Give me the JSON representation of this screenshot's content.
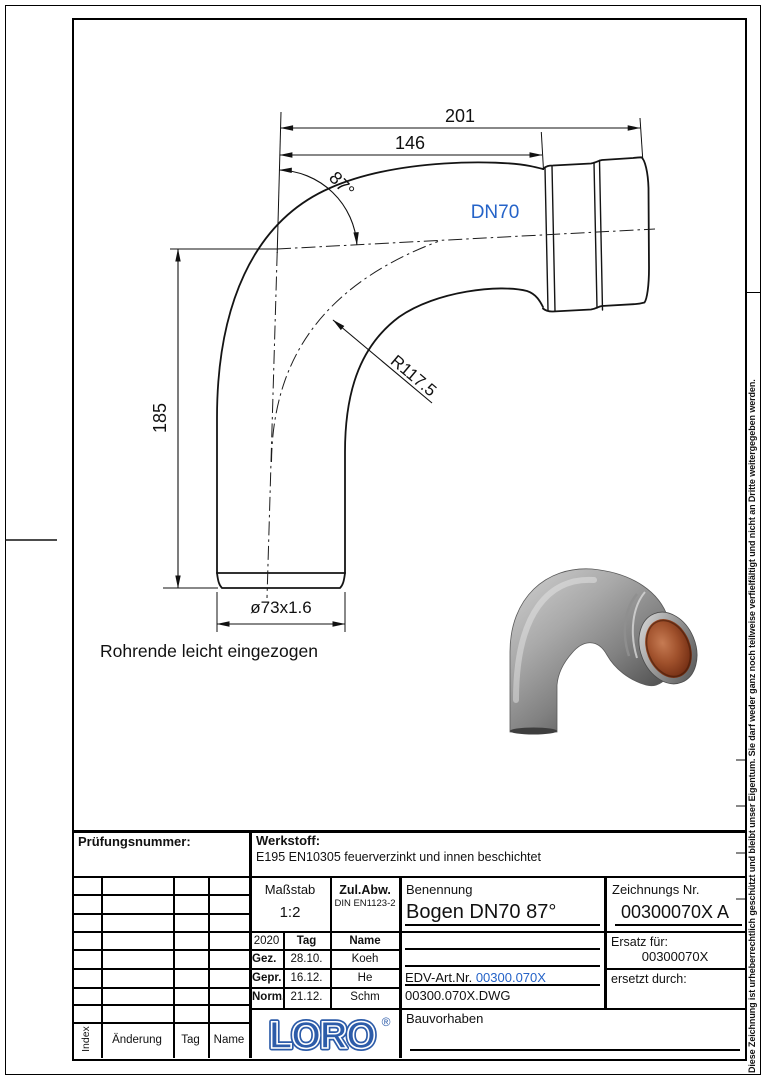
{
  "colors": {
    "ink": "#111111",
    "blue": "#2563c8",
    "logo_blue": "#2d5ca9",
    "copper": "#a0512c"
  },
  "drawing": {
    "dim_total_length": "201",
    "dim_tangent_length": "146",
    "dim_angle": "87°",
    "dim_leg_height": "185",
    "dim_pipe_od": "ø73x1.6",
    "dim_bend_radius": "R117.5",
    "nominal_size": "DN70",
    "note_pipe_end": "Rohrende leicht eingezogen"
  },
  "titleblock": {
    "pruefungsnummer_label": "Prüfungsnummer:",
    "werkstoff_label": "Werkstoff:",
    "werkstoff_value": "E195 EN10305 feuerverzinkt und innen beschichtet",
    "massstab_label": "Maßstab",
    "massstab_value": "1:2",
    "zul_abw_label": "Zul.Abw.",
    "zul_abw_value": "DIN EN1123-2",
    "benennung_label": "Benennung",
    "benennung_value": "Bogen DN70 87°",
    "zeichnungs_nr_label": "Zeichnungs Nr.",
    "zeichnungs_nr_value": "00300070X A",
    "ersatz_fuer_label": "Ersatz für:",
    "ersatz_fuer_value": "00300070X",
    "ersetzt_durch_label": "ersetzt durch:",
    "edv_art_nr_label": "EDV-Art.Nr.",
    "edv_art_nr_value": "00300.070X",
    "dwg_file": "00300.070X.DWG",
    "bauvorhaben_label": "Bauvorhaben",
    "approval": {
      "year": "2020",
      "tag_header": "Tag",
      "name_header": "Name",
      "rows": [
        {
          "role": "Gez.",
          "date": "28.10.",
          "name": "Koeh"
        },
        {
          "role": "Gepr.",
          "date": "16.12.",
          "name": "He"
        },
        {
          "role": "Norm.",
          "date": "21.12.",
          "name": "Schm"
        }
      ]
    },
    "revision": {
      "index_label": "Index",
      "aenderung_label": "Änderung",
      "tag_label": "Tag",
      "name_label": "Name"
    },
    "logo_text": "LORO",
    "logo_reg": "®"
  },
  "margin": {
    "copyright": "Diese Zeichnung ist urheberrechtlich geschützt und bleibt unser Eigentum. Sie darf weder ganz noch teilweise verfielfältigt und nicht an Dritte weitergegeben werden."
  }
}
